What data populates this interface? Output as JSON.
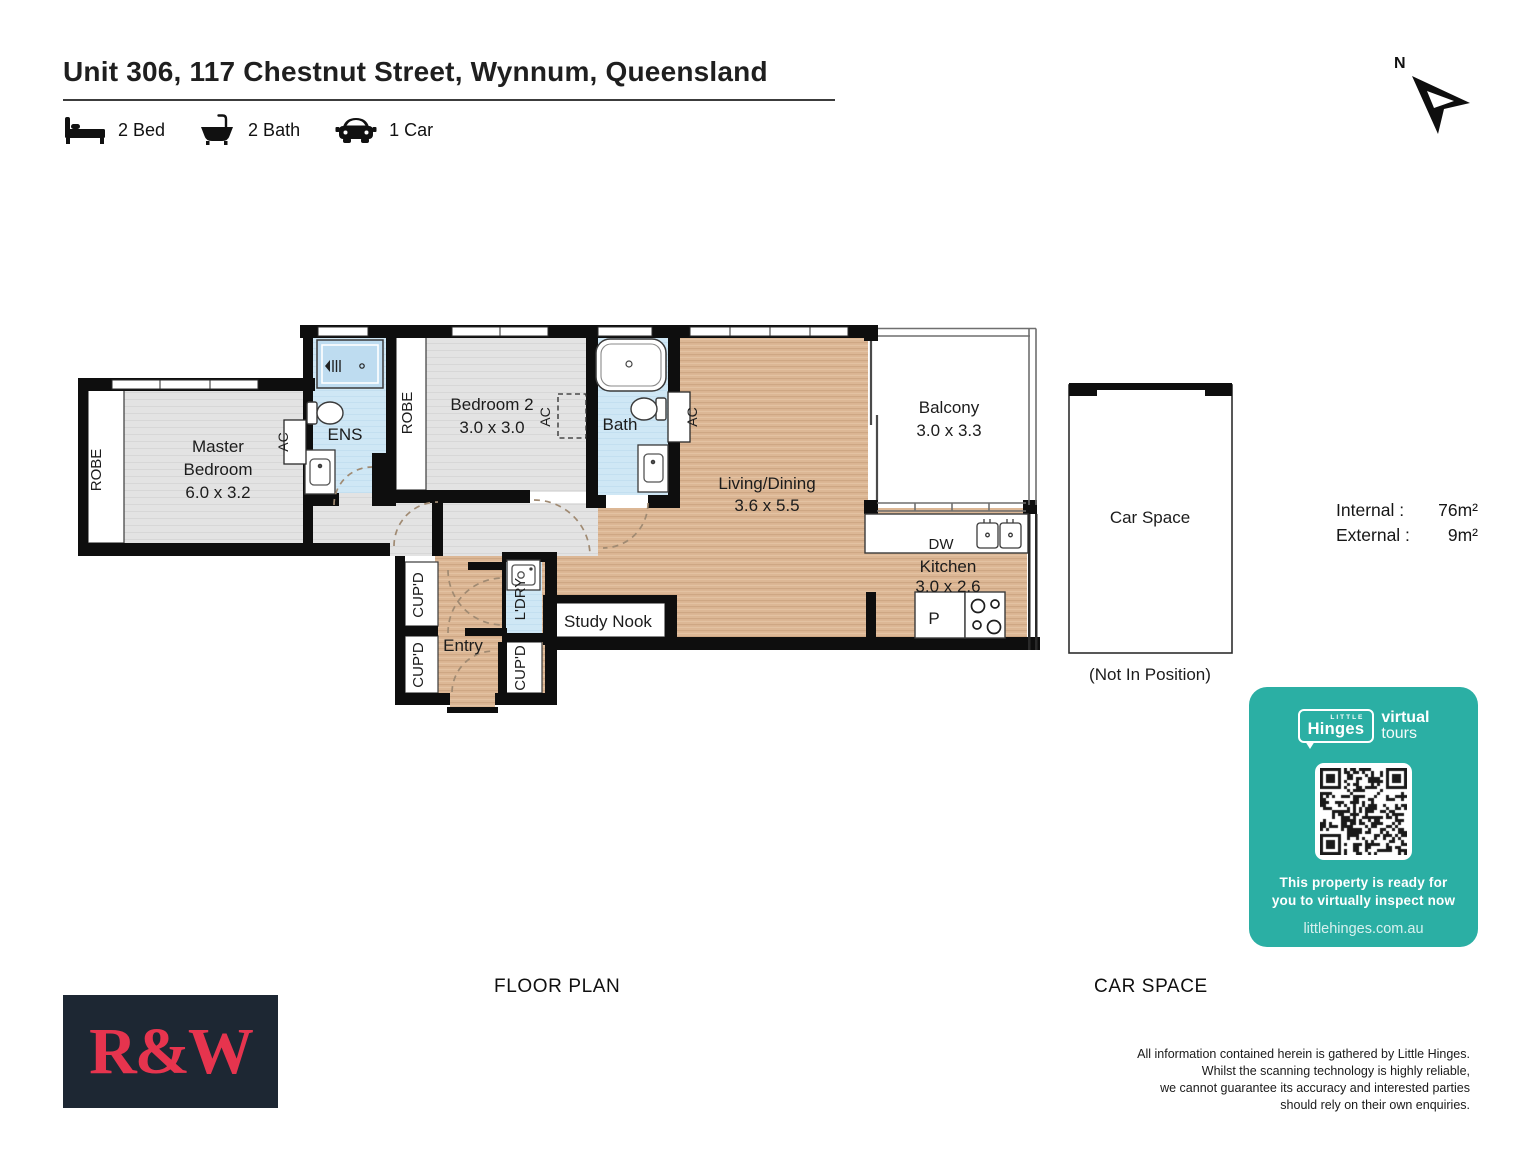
{
  "header": {
    "title": "Unit 306, 117 Chestnut Street, Wynnum, Queensland",
    "features": {
      "beds": "2 Bed",
      "baths": "2 Bath",
      "cars": "1 Car"
    }
  },
  "compass": {
    "north": "N"
  },
  "rooms": {
    "master": {
      "line1": "Master",
      "line2": "Bedroom",
      "dims": "6.0 x 3.2"
    },
    "bedroom2": {
      "name": "Bedroom 2",
      "dims": "3.0 x 3.0"
    },
    "ens": "ENS",
    "bath": "Bath",
    "living": {
      "name": "Living/Dining",
      "dims": "3.6 x 5.5"
    },
    "balcony": {
      "name": "Balcony",
      "dims": "3.0 x 3.3"
    },
    "kitchen": {
      "name": "Kitchen",
      "dims": "3.0 x 2.6"
    },
    "dw": "DW",
    "pantry": "P",
    "study": "Study Nook",
    "entry": "Entry",
    "robe": "ROBE",
    "cupboard": "CUP'D",
    "laundry": "L'DRY",
    "ac": "AC"
  },
  "car_space": {
    "label": "Car Space",
    "note": "(Not In Position)"
  },
  "areas": {
    "internal_label": "Internal :",
    "internal_value": "76m²",
    "external_label": "External :",
    "external_value": "9m²"
  },
  "sections": {
    "floor_plan": "FLOOR PLAN",
    "car_space": "CAR SPACE"
  },
  "badge": {
    "little": "LITTLE",
    "hinges": "Hinges",
    "virtual": "virtual",
    "tours": "tours",
    "line1": "This property is ready for",
    "line2": "you to virtually inspect now",
    "url": "littlehinges.com.au"
  },
  "logo": {
    "text": "R&W"
  },
  "disclaimer": [
    "All information contained herein is gathered by Little Hinges.",
    "Whilst the scanning technology is highly reliable,",
    "we cannot guarantee its accuracy and interested parties",
    "should rely on their own enquiries."
  ],
  "colors": {
    "teal": "#2bafa4",
    "logo_bg": "#1d2733",
    "logo_red": "#e6344e",
    "wall": "#0e0e0e",
    "wood": "#dcb795",
    "carpet": "#e4e4e4",
    "wet_area": "#cfe7f5"
  }
}
